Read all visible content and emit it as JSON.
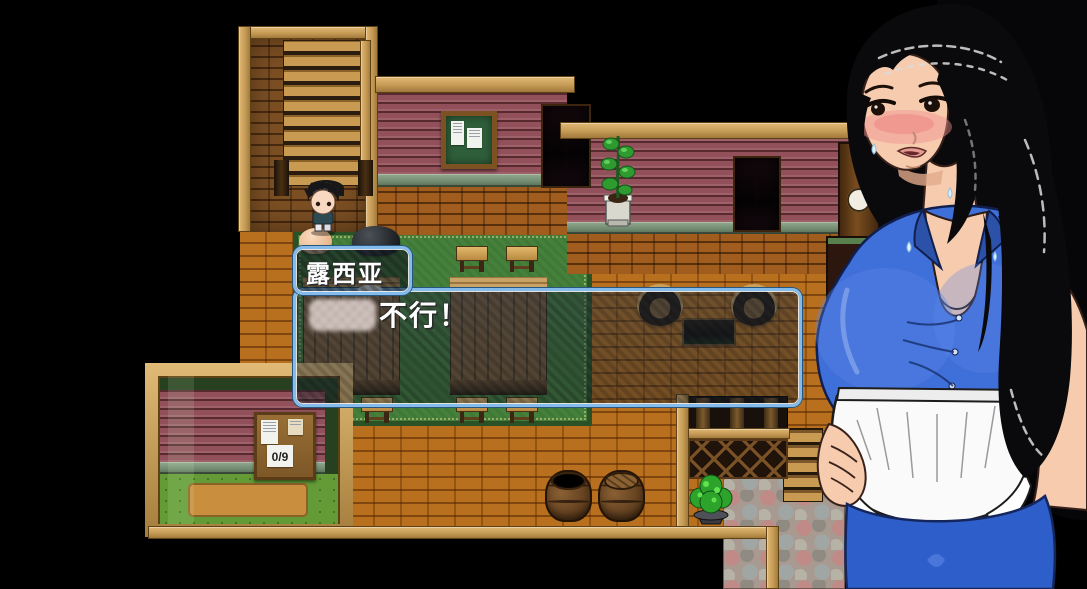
{
  "game": {
    "dialogue": {
      "speaker_name": "露西亚",
      "text": "不行！"
    },
    "quest_board": {
      "counter": "0/9"
    }
  },
  "palette": {
    "background": "#000000",
    "dialog_border": "#84bbea",
    "floor_brick": "#b9701e",
    "wall_red": "#91505a",
    "wall_brick_brown": "#7c4f23",
    "rug_green": "#45813b",
    "wood_frame": "#c9a267",
    "blouse_blue": "#3f6fd8",
    "apron_white": "#f8f8f8",
    "hair_black": "#0a0a0c",
    "skin": "#f6cbae"
  }
}
